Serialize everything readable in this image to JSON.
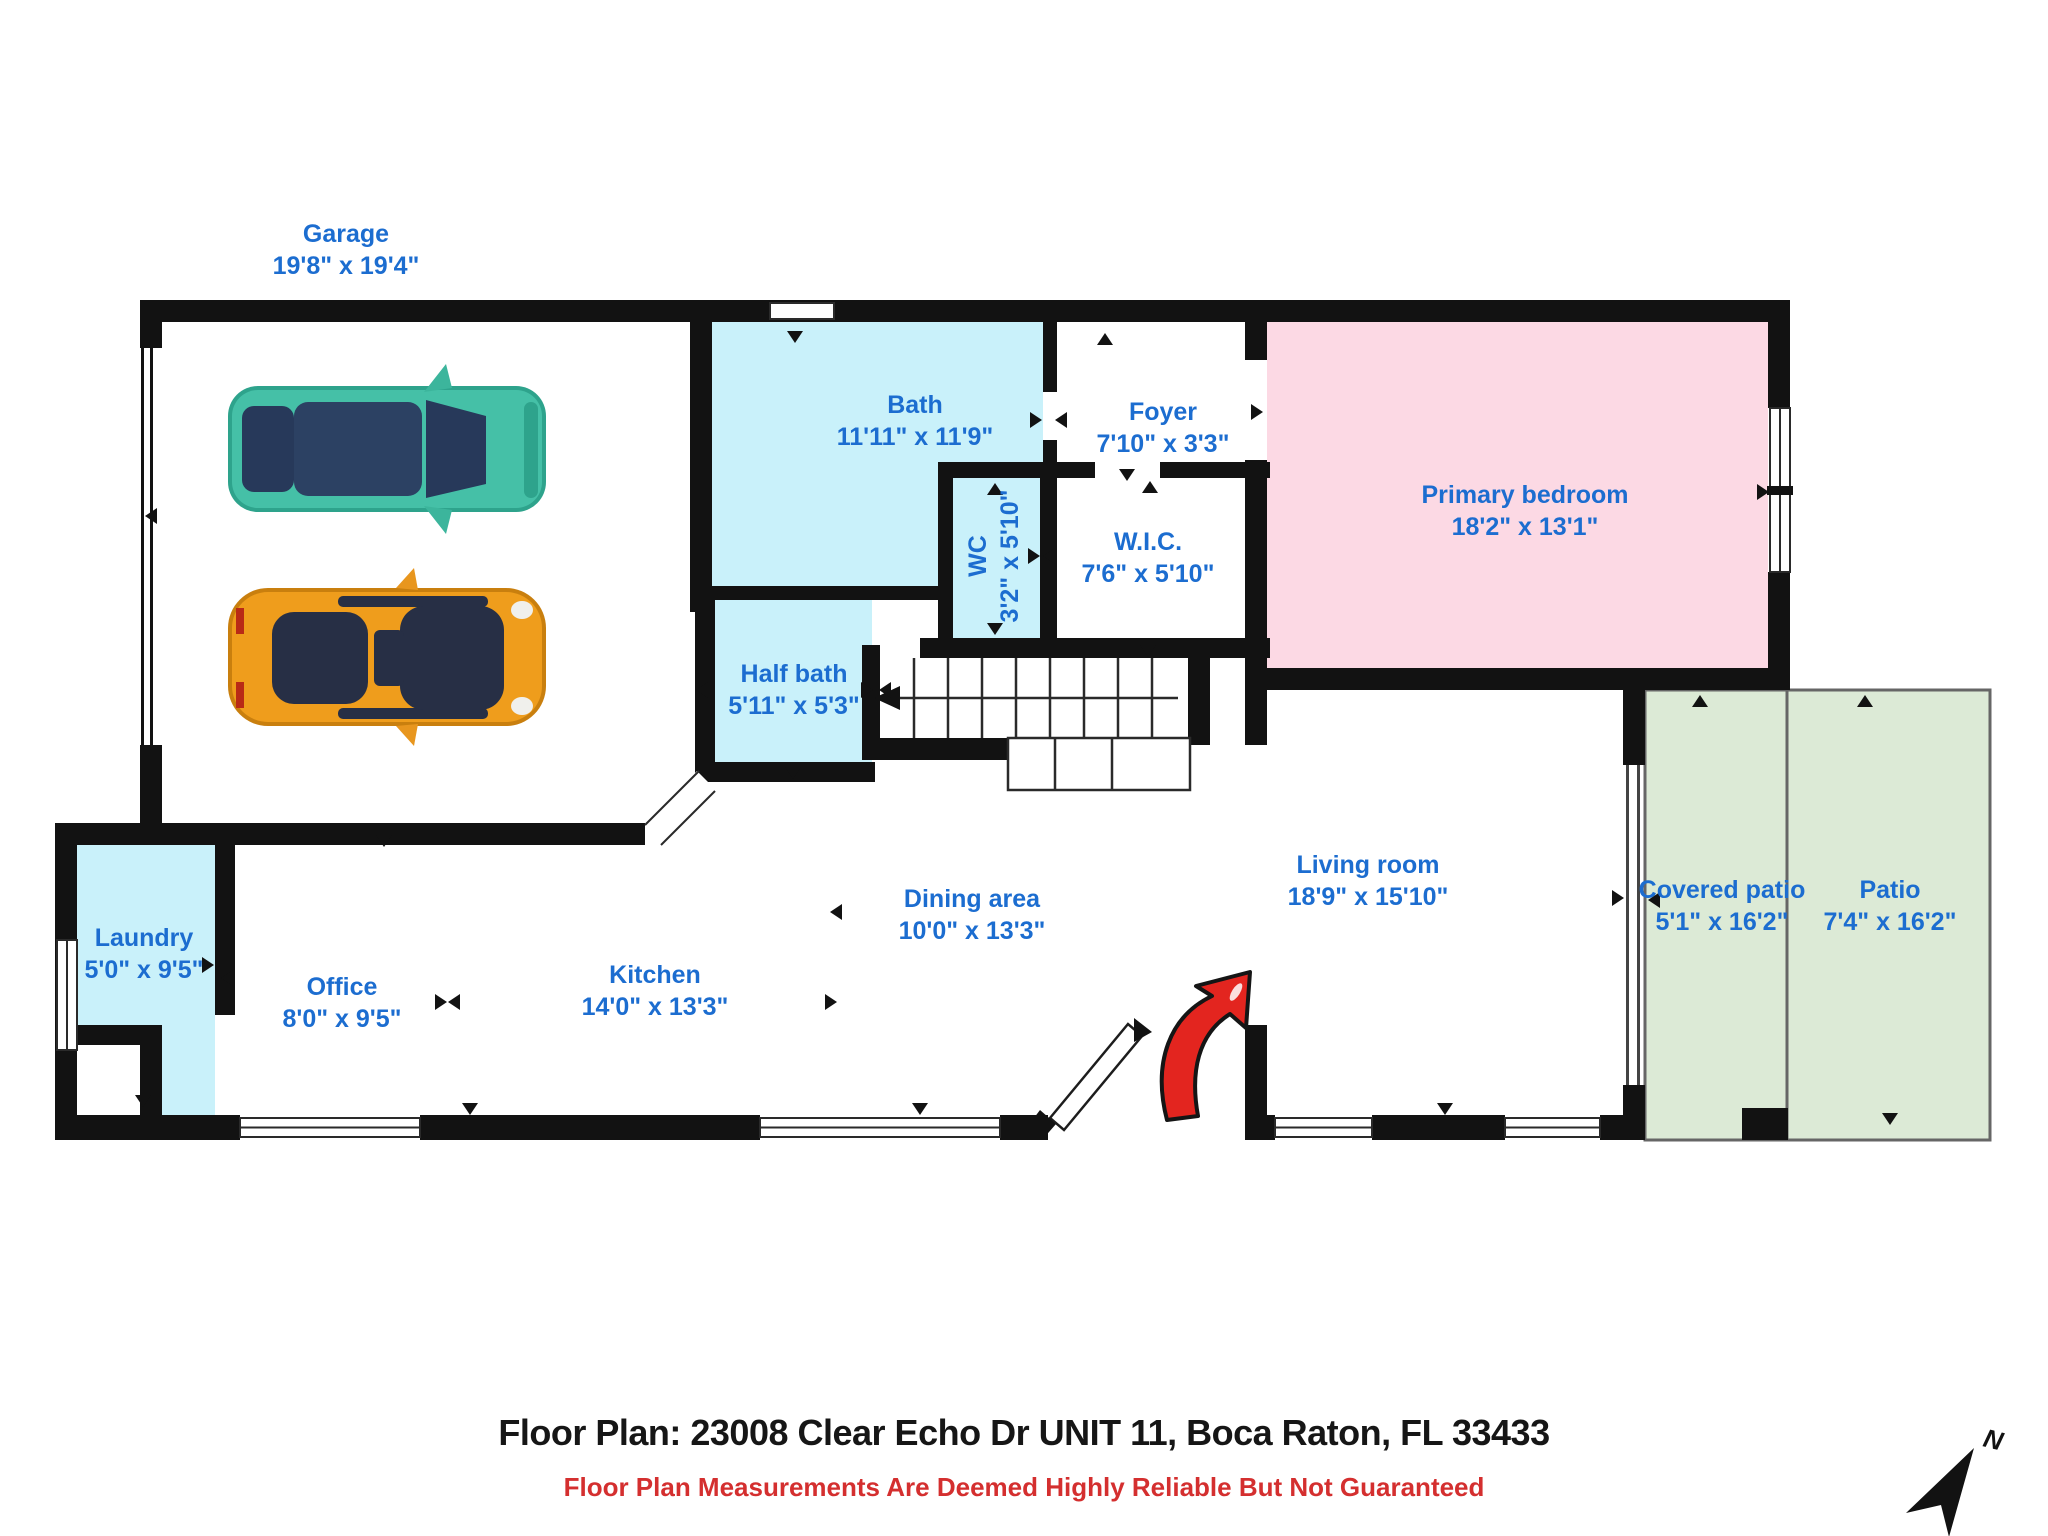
{
  "colors": {
    "label_blue": "#1c6dd0",
    "wall_black": "#121212",
    "bath_cyan": "#c9f1fa",
    "bedroom_pink": "#fcd9e4",
    "patio_green": "#dcead6",
    "entry_arrow_red": "#e3251f",
    "footer_text_black": "#161616",
    "footer_note_red": "#d42f2f",
    "car_teal": "#45c0a7",
    "car_orange": "#ef9d1c"
  },
  "rooms": [
    {
      "id": "garage",
      "name": "Garage",
      "dims": "19'8\" x 19'4\""
    },
    {
      "id": "bath",
      "name": "Bath",
      "dims": "11'11\" x 11'9\""
    },
    {
      "id": "foyer",
      "name": "Foyer",
      "dims": "7'10\" x 3'3\""
    },
    {
      "id": "wc",
      "name": "WC",
      "dims": "3'2\" x 5'10\""
    },
    {
      "id": "wic",
      "name": "W.I.C.",
      "dims": "7'6\" x 5'10\""
    },
    {
      "id": "primary-bedroom",
      "name": "Primary bedroom",
      "dims": "18'2\" x 13'1\""
    },
    {
      "id": "half-bath",
      "name": "Half bath",
      "dims": "5'11\" x 5'3\""
    },
    {
      "id": "laundry",
      "name": "Laundry",
      "dims": "5'0\" x 9'5\""
    },
    {
      "id": "office",
      "name": "Office",
      "dims": "8'0\" x 9'5\""
    },
    {
      "id": "kitchen",
      "name": "Kitchen",
      "dims": "14'0\" x 13'3\""
    },
    {
      "id": "dining-area",
      "name": "Dining area",
      "dims": "10'0\" x 13'3\""
    },
    {
      "id": "living-room",
      "name": "Living room",
      "dims": "18'9\" x 15'10\""
    },
    {
      "id": "covered-patio",
      "name": "Covered patio",
      "dims": "5'1\" x 16'2\""
    },
    {
      "id": "patio",
      "name": "Patio",
      "dims": "7'4\" x 16'2\""
    }
  ],
  "footer": {
    "title": "Floor Plan: 23008 Clear Echo Dr UNIT 11, Boca Raton, FL 33433",
    "disclaimer": "Floor Plan Measurements Are Deemed Highly Reliable But Not Guaranteed"
  },
  "compass": {
    "label": "N"
  }
}
